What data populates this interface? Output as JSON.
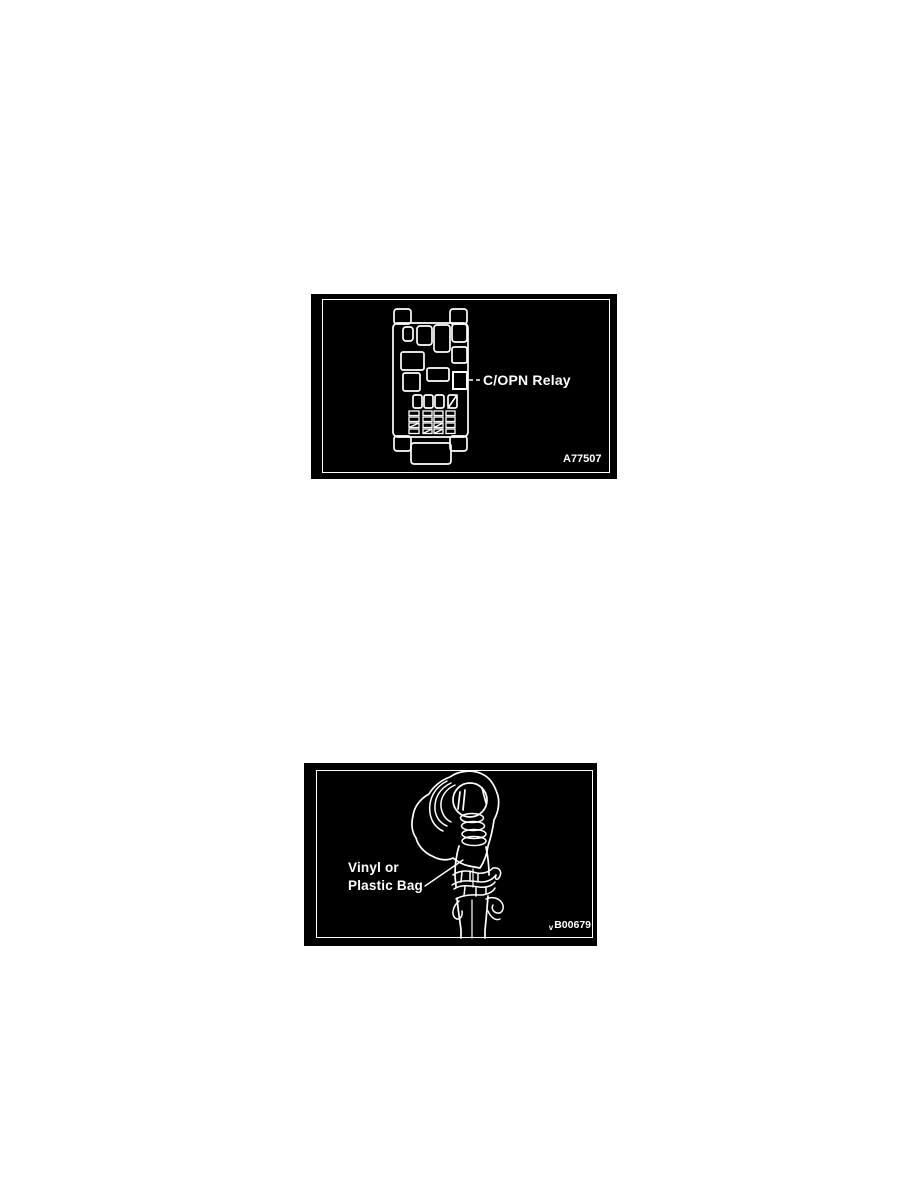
{
  "colors": {
    "page_bg": "#ffffff",
    "panel_bg": "#000000",
    "line": "#ffffff"
  },
  "figure1": {
    "callout_label": "C/OPN Relay",
    "figure_code": "A77507"
  },
  "figure2": {
    "callout_line1": "Vinyl or",
    "callout_line2": "Plastic Bag",
    "figure_code_prefix": "v",
    "figure_code": "B00679"
  }
}
